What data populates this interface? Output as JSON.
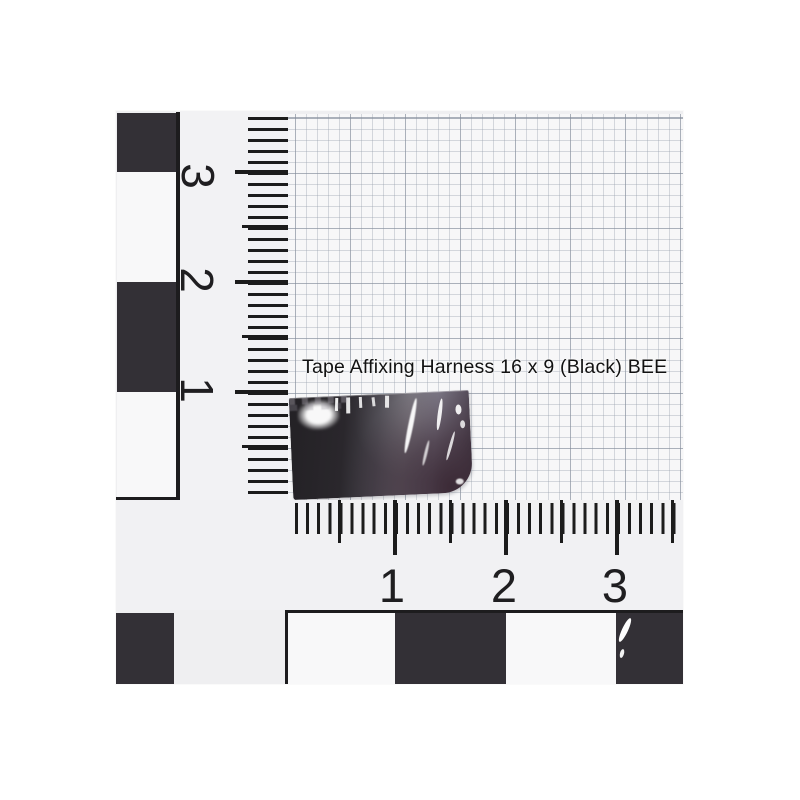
{
  "photo": {
    "annotation": "Tape Affixing Harness 16 x 9 (Black) BEE",
    "vertical_scale": {
      "labels": [
        "3",
        "2",
        "1"
      ]
    },
    "horizontal_scale": {
      "labels": [
        "1",
        "2",
        "3"
      ]
    },
    "colors": {
      "scale_black": "#333036",
      "tick_black": "#1c1c1c",
      "paper_white": "#efeff1",
      "graph_paper": "#f7f7f8",
      "grid_line": "#98a0ac",
      "tape_dark": "#232125",
      "tape_gray": "#6b6770",
      "tape_sheen_purple": "#3a2834"
    }
  }
}
